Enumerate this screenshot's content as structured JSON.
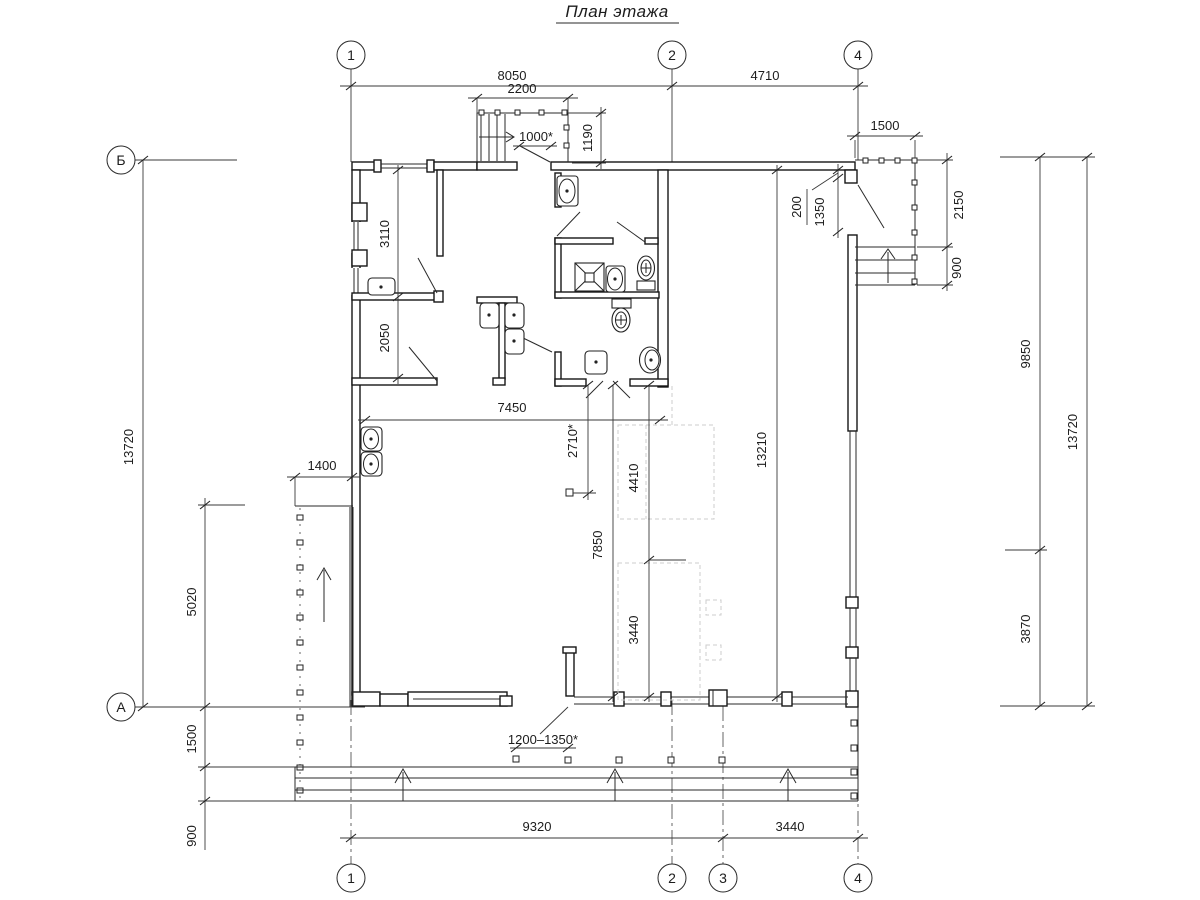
{
  "title": "План этажа",
  "axes": {
    "top": [
      "1",
      "2",
      "4"
    ],
    "bottom": [
      "1",
      "2",
      "3",
      "4"
    ],
    "left": [
      "Б",
      "А"
    ]
  },
  "dims": {
    "top_8050": "8050",
    "top_4710": "4710",
    "vest_2200": "2200",
    "vest_1000": "1000*",
    "vest_1190": "1190",
    "porch_1500": "1500",
    "porch_200": "200",
    "porch_1350": "1350",
    "porch_2150": "2150",
    "porch_900": "900",
    "room_3110": "3110",
    "room_2050": "2050",
    "hall_7450": "7450",
    "hall_2710": "2710*",
    "hall_4410": "4410",
    "hall_7850": "7850",
    "hall_3440": "3440",
    "hall_13210": "13210",
    "ramp_1400": "1400",
    "left_5020": "5020",
    "left_13720": "13720",
    "left_1500": "1500",
    "left_900": "900",
    "door_1200_1350": "1200–1350*",
    "bottom_9320": "9320",
    "bottom_3440": "3440",
    "right_9850": "9850",
    "right_3870": "3870",
    "right_13720": "13720"
  },
  "line_color": "#161616",
  "dim_color": "#1c1c1c"
}
